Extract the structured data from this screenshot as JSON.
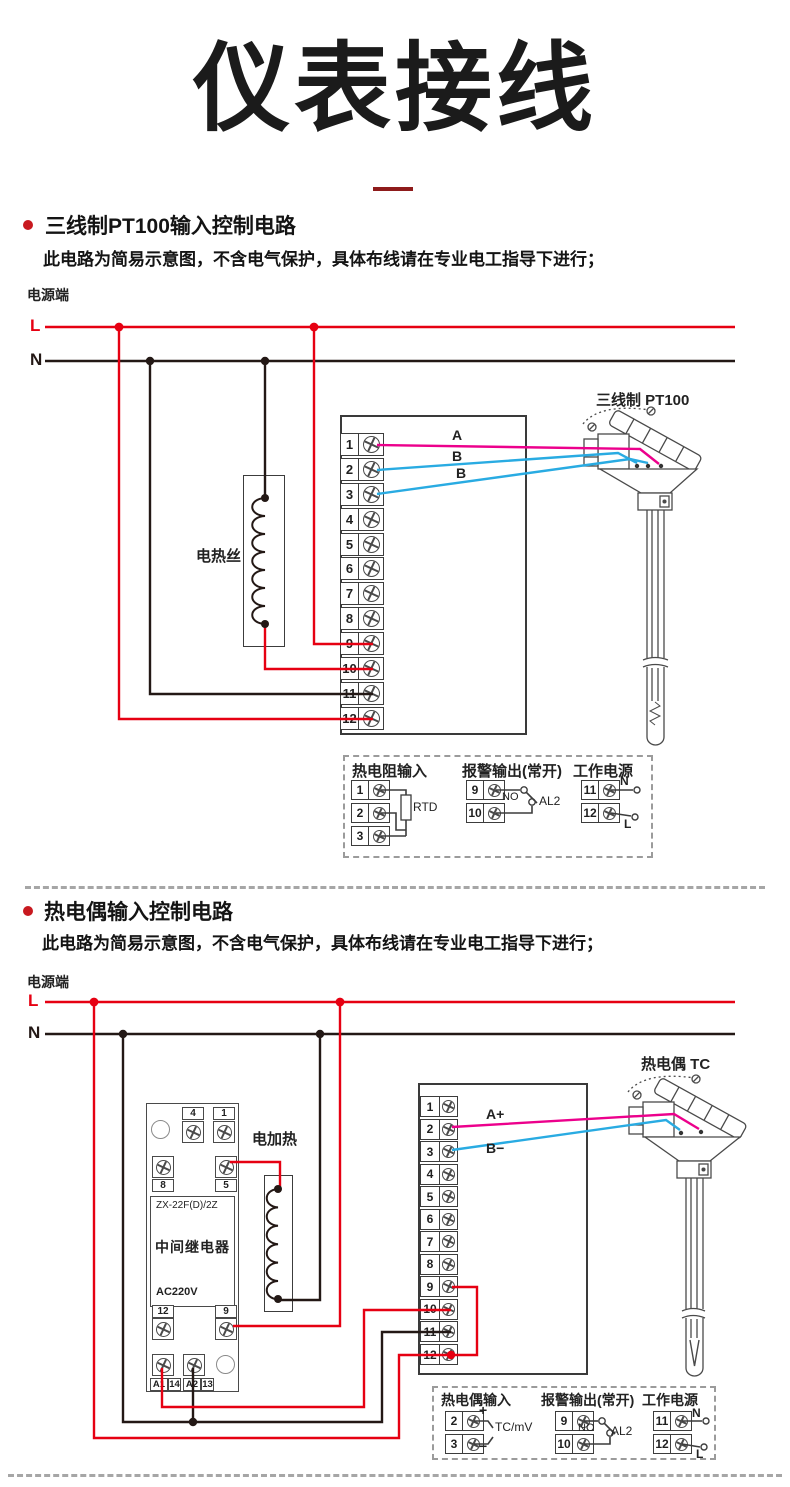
{
  "header": {
    "title": "仪表接线"
  },
  "colors": {
    "accent_red": "#e60012",
    "wire_black": "#231815",
    "wire_magenta": "#ec008c",
    "wire_blue": "#29abe2",
    "underline_red": "#8e1b1b"
  },
  "sections": [
    {
      "heading": "三线制PT100输入控制电路",
      "note": "此电路为简易示意图，不含电气保护，具体布线请在专业电工指导下进行；",
      "power_label": "电源端",
      "l_label": "L",
      "n_label": "N",
      "heater_label": "电热丝",
      "sensor_label": "三线制 PT100",
      "wire_labels": [
        "A",
        "B",
        "B"
      ],
      "terminals": [
        "1",
        "2",
        "3",
        "4",
        "5",
        "6",
        "7",
        "8",
        "9",
        "10",
        "11",
        "12"
      ],
      "legend": {
        "groups": [
          {
            "title": "热电阻输入",
            "terminals": [
              "1",
              "2",
              "3"
            ],
            "component": "RTD"
          },
          {
            "title": "报警输出(常开)",
            "terminals": [
              "9",
              "10"
            ],
            "no_label": "NO",
            "alarm_label": "AL2"
          },
          {
            "title": "工作电源",
            "terminals": [
              "11",
              "12"
            ],
            "n_label": "N",
            "l_label": "L"
          }
        ]
      }
    },
    {
      "heading": "热电偶输入控制电路",
      "note": "此电路为简易示意图，不含电气保护，具体布线请在专业电工指导下进行；",
      "power_label": "电源端",
      "l_label": "L",
      "n_label": "N",
      "heater_label": "电加热",
      "sensor_label": "热电偶 TC",
      "wire_labels": [
        "A+",
        "B−"
      ],
      "terminals": [
        "1",
        "2",
        "3",
        "4",
        "5",
        "6",
        "7",
        "8",
        "9",
        "10",
        "11",
        "12"
      ],
      "relay": {
        "model": "ZX-22F(D)/2Z",
        "name": "中间继电器",
        "voltage": "AC220V",
        "top_labels": [
          "4",
          "1"
        ],
        "mid_labels": [
          "8",
          "5"
        ],
        "low_labels": [
          "12",
          "9"
        ],
        "bottom_labels": [
          "A1",
          "14",
          "A2",
          "13"
        ]
      },
      "legend": {
        "groups": [
          {
            "title": "热电偶输入",
            "terminals": [
              "2",
              "3"
            ],
            "plus": "+",
            "minus": "−",
            "component": "TC/mV"
          },
          {
            "title": "报警输出(常开)",
            "terminals": [
              "9",
              "10"
            ],
            "no_label": "NO",
            "alarm_label": "AL2"
          },
          {
            "title": "工作电源",
            "terminals": [
              "11",
              "12"
            ],
            "n_label": "N",
            "l_label": "L"
          }
        ]
      }
    }
  ]
}
